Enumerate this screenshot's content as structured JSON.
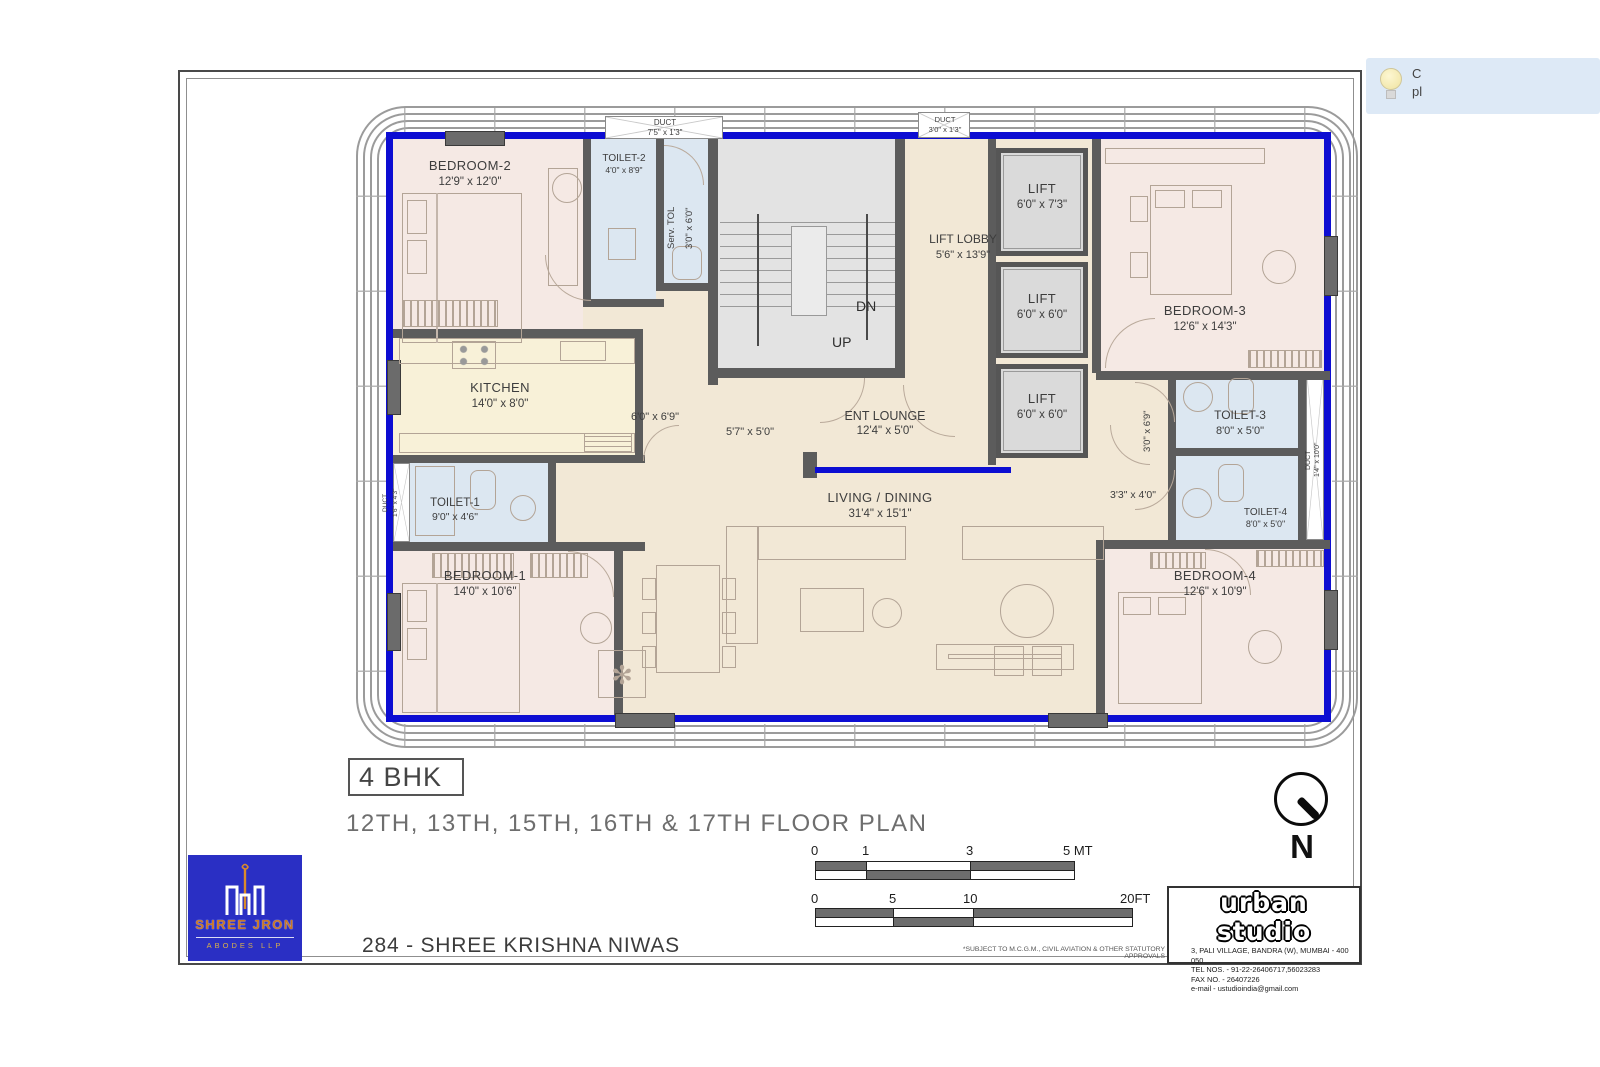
{
  "tooltip": {
    "line1": "C",
    "line2": "pl"
  },
  "plan": {
    "rooms": [
      {
        "name": "BEDROOM-2",
        "dims": "12'9\" x 12'0\""
      },
      {
        "name": "TOILET-2",
        "dims": "4'0\" x 8'9\""
      },
      {
        "name": "Serv. TOL",
        "dims": "3'0\" x 6'0\""
      },
      {
        "name": "LIFT LOBBY",
        "dims": "5'6\" x 13'9\""
      },
      {
        "name": "LIFT",
        "dims": "6'0\" x 7'3\""
      },
      {
        "name": "LIFT",
        "dims": "6'0\" x 6'0\""
      },
      {
        "name": "LIFT",
        "dims": "6'0\" x 6'0\""
      },
      {
        "name": "BEDROOM-3",
        "dims": "12'6\" x 14'3\""
      },
      {
        "name": "KITCHEN",
        "dims": "14'0\" x 8'0\""
      },
      {
        "name": "TOILET-1",
        "dims": "9'0\" x 4'6\""
      },
      {
        "name": "BEDROOM-1",
        "dims": "14'0\" x 10'6\""
      },
      {
        "name": "ENT LOUNGE",
        "dims": "12'4\" x 5'0\""
      },
      {
        "name": "LIVING / DINING",
        "dims": "31'4\" x 15'1\""
      },
      {
        "name": "TOILET-3",
        "dims": "8'0\" x 5'0\""
      },
      {
        "name": "TOILET-4",
        "dims": "8'0\" x 5'0\""
      },
      {
        "name": "BEDROOM-4",
        "dims": "12'6\" x 10'9\""
      }
    ],
    "ducts": [
      {
        "name": "DUCT",
        "dims": "7'5\" x 1'3\""
      },
      {
        "name": "DUCT",
        "dims": "3'0\" x 1'3\""
      },
      {
        "name": "DUCT",
        "dims": "1'6\" x 4'3\""
      },
      {
        "name": "DUCT",
        "dims": "1'4\" x 10'0\""
      }
    ],
    "stairs": {
      "up": "UP",
      "down": "DN"
    },
    "passages": [
      "6'0\" x 6'9\"",
      "5'7\" x 5'0\"",
      "3'0\" x 6'9\"",
      "3'3\" x 4'0\""
    ]
  },
  "titleblock": {
    "unit_type": "4 BHK",
    "floor_title": "12TH, 13TH, 15TH, 16TH & 17TH FLOOR PLAN",
    "project_name": "284 - SHREE KRISHNA NIWAS",
    "disclaimer": "*SUBJECT TO M.C.G.M., CIVIL AVIATION & OTHER STATUTORY APPROVALS",
    "north_label": "N",
    "scale_mt": {
      "ticks": [
        "0",
        "1",
        "3",
        "5 MT"
      ]
    },
    "scale_ft": {
      "ticks": [
        "0",
        "5",
        "10",
        "20FT"
      ]
    },
    "architect": {
      "name": "urban studio",
      "address": "3, PALI VILLAGE, BANDRA (W), MUMBAI - 400 050",
      "tel": "TEL NOS. - 91-22-26406717,56023283",
      "fax": "FAX NO. - 26407226",
      "email": "e-mail - ustudioindia@gmail.com"
    },
    "developer": {
      "mark": "श्री",
      "name": "SHREE JRON",
      "subtitle": "ABODES LLP"
    }
  },
  "colors": {
    "outer_wall_blue": "#0d0dd2",
    "wall_gray": "#5c5c5c",
    "bedroom": "#f5e9e4",
    "toilet": "#dce7f1",
    "kitchen": "#f8f1d8",
    "common": "#f2e8d6",
    "stair": "#e3e3e3",
    "lift": "#dadada",
    "logo_blue": "#2a2fc4"
  }
}
